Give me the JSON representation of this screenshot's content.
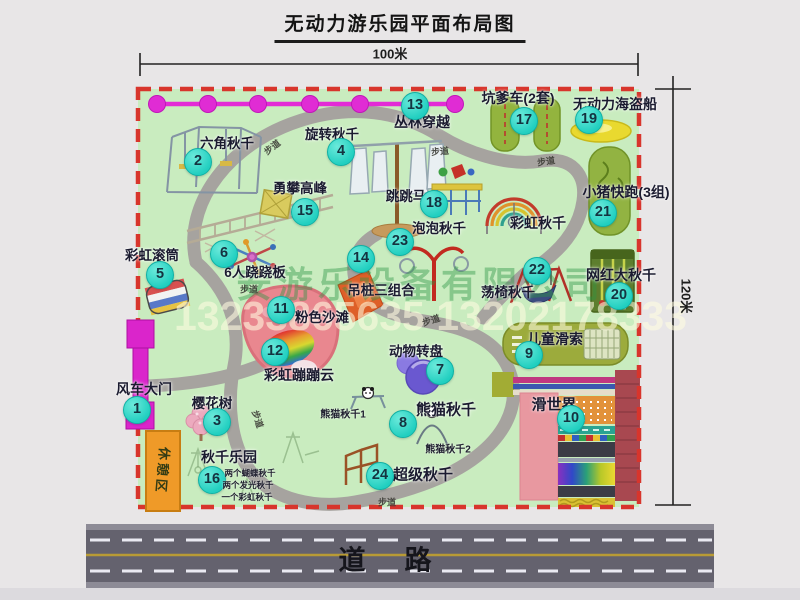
{
  "title": "无动力游乐园平面布局图",
  "dimensions": {
    "width_label": "100米",
    "height_label": "120米"
  },
  "road": {
    "label": "道　路"
  },
  "rest_area": {
    "label": "休憩区"
  },
  "watermark": {
    "company": "安游乐设备有限公司",
    "phone": "13233865635 13202178333"
  },
  "map": {
    "walkway_text": "步道",
    "walkway_labels": [
      {
        "x": 272,
        "y": 147,
        "rot": -38
      },
      {
        "x": 440,
        "y": 151,
        "rot": -5
      },
      {
        "x": 546,
        "y": 161,
        "rot": -8
      },
      {
        "x": 249,
        "y": 289,
        "rot": 0
      },
      {
        "x": 258,
        "y": 419,
        "rot": 72
      },
      {
        "x": 387,
        "y": 502,
        "rot": 0
      },
      {
        "x": 431,
        "y": 320,
        "rot": -18
      }
    ],
    "sub_labels": [
      {
        "text": "熊猫秋千1",
        "x": 343,
        "y": 413,
        "fs": 10
      },
      {
        "text": "熊猫秋千2",
        "x": 448,
        "y": 448,
        "fs": 10
      },
      {
        "text": "两个蝴蝶秋千",
        "x": 250,
        "y": 473,
        "fs": 8.5
      },
      {
        "text": "两个发光秋千",
        "x": 248,
        "y": 485,
        "fs": 8.5
      },
      {
        "text": "一个彩虹秋千",
        "x": 247,
        "y": 497,
        "fs": 8.5
      }
    ],
    "attractions": [
      {
        "id": "windmill-gate",
        "num": "1",
        "label": "风车大门",
        "badge": [
          137,
          410
        ],
        "label_pos": [
          144,
          389
        ],
        "fs": 14
      },
      {
        "id": "hexagon-swing",
        "num": "2",
        "label": "六角秋千",
        "badge": [
          198,
          162
        ],
        "label_pos": [
          227,
          142
        ],
        "fs": 13.5
      },
      {
        "id": "cherry-tree",
        "num": "3",
        "label": "樱花树",
        "badge": [
          217,
          422
        ],
        "label_pos": [
          212,
          402
        ],
        "fs": 13.5
      },
      {
        "id": "rotating-swing",
        "num": "4",
        "label": "旋转秋千",
        "badge": [
          341,
          152
        ],
        "label_pos": [
          332,
          133
        ],
        "fs": 13.5
      },
      {
        "id": "rainbow-roller",
        "num": "5",
        "label": "彩虹滚筒",
        "badge": [
          160,
          275
        ],
        "label_pos": [
          152,
          254
        ],
        "fs": 13.5
      },
      {
        "id": "seesaw-6p",
        "num": "6",
        "label": "6人跷跷板",
        "badge": [
          224,
          254
        ],
        "label_pos": [
          255,
          271
        ],
        "fs": 13.5
      },
      {
        "id": "animal-carousel",
        "num": "7",
        "label": "动物转盘",
        "badge": [
          440,
          371
        ],
        "label_pos": [
          416,
          350
        ],
        "fs": 13.5
      },
      {
        "id": "panda-swing",
        "num": "8",
        "label": "熊猫秋千",
        "badge": [
          403,
          424
        ],
        "label_pos": [
          446,
          409
        ],
        "fs": 15
      },
      {
        "id": "kids-zipline",
        "num": "9",
        "label": "儿童滑索",
        "badge": [
          529,
          355
        ],
        "label_pos": [
          555,
          339
        ],
        "fs": 14
      },
      {
        "id": "slide-world",
        "num": "10",
        "label": "滑世界",
        "badge": [
          571,
          419
        ],
        "label_pos": [
          554,
          404
        ],
        "fs": 15
      },
      {
        "id": "pink-beach",
        "num": "11",
        "label": "粉色沙滩",
        "badge": [
          281,
          310
        ],
        "label_pos": [
          322,
          316
        ],
        "fs": 13.5
      },
      {
        "id": "rainbow-cloud",
        "num": "12",
        "label": "彩虹蹦蹦云",
        "badge": [
          275,
          352
        ],
        "label_pos": [
          299,
          375
        ],
        "fs": 14
      },
      {
        "id": "jungle-crossing",
        "num": "13",
        "label": "丛林穿越",
        "badge": [
          415,
          106
        ],
        "label_pos": [
          422,
          122
        ],
        "fs": 14
      },
      {
        "id": "hanging-piles",
        "num": "14",
        "label": "吊桩三组合",
        "badge": [
          361,
          259
        ],
        "label_pos": [
          381,
          289
        ],
        "fs": 13.5
      },
      {
        "id": "climbing-peak",
        "num": "15",
        "label": "勇攀高峰",
        "badge": [
          305,
          212
        ],
        "label_pos": [
          300,
          187
        ],
        "fs": 13.5
      },
      {
        "id": "swing-park",
        "num": "16",
        "label": "秋千乐园",
        "badge": [
          212,
          480
        ],
        "label_pos": [
          229,
          457
        ],
        "fs": 14
      },
      {
        "id": "pedal-car",
        "num": "17",
        "label": "坑爹车(2套)",
        "badge": [
          524,
          121
        ],
        "label_pos": [
          518,
          98
        ],
        "fs": 14
      },
      {
        "id": "jumping-horse",
        "num": "18",
        "label": "跳跳马",
        "badge": [
          434,
          204
        ],
        "label_pos": [
          406,
          195
        ],
        "fs": 13.5
      },
      {
        "id": "pirate-ship",
        "num": "19",
        "label": "无动力海盗船",
        "badge": [
          589,
          120
        ],
        "label_pos": [
          615,
          104
        ],
        "fs": 14
      },
      {
        "id": "big-swing",
        "num": "20",
        "label": "网红大秋千",
        "badge": [
          619,
          296
        ],
        "label_pos": [
          621,
          275
        ],
        "fs": 14
      },
      {
        "id": "piggy-run",
        "num": "21",
        "label": "小猪快跑(3组)",
        "badge": [
          603,
          213
        ],
        "label_pos": [
          626,
          192
        ],
        "fs": 14
      },
      {
        "id": "chair-swing",
        "num": "22",
        "label": "荡椅秋千",
        "badge": [
          537,
          271
        ],
        "label_pos": [
          508,
          291
        ],
        "fs": 13.5
      },
      {
        "id": "bubble-swing",
        "num": "23",
        "label": "泡泡秋千",
        "badge": [
          400,
          242
        ],
        "label_pos": [
          439,
          227
        ],
        "fs": 13.5
      },
      {
        "id": "super-swing",
        "num": "24",
        "label": "超级秋千",
        "badge": [
          380,
          476
        ],
        "label_pos": [
          423,
          474
        ],
        "fs": 15
      },
      {
        "id": "rainbow-swing",
        "num": "",
        "label": "彩虹秋千",
        "label_pos": [
          538,
          223
        ],
        "fs": 14
      }
    ]
  }
}
